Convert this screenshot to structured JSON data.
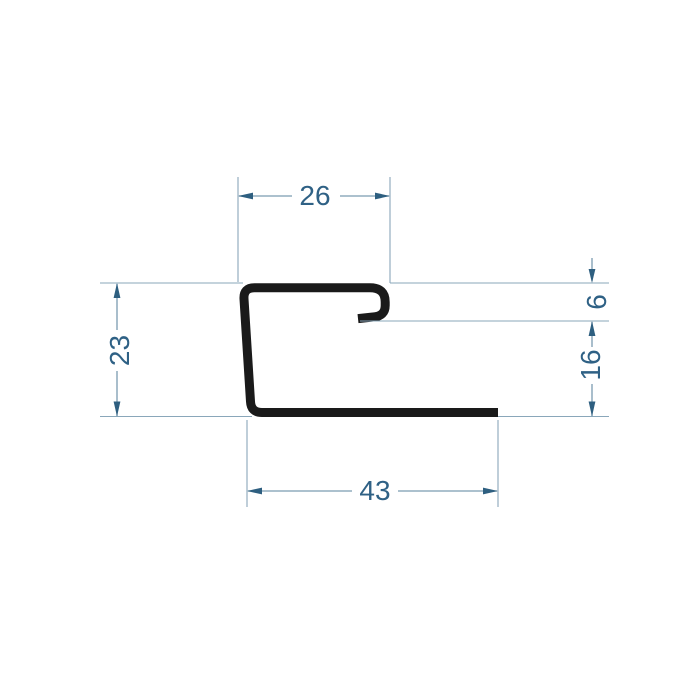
{
  "drawing": {
    "kind": "technical-profile-cross-section",
    "colors": {
      "background": "#ffffff",
      "profile_outline": "#1a1a1a",
      "dimension_lines": "#7b9cb1",
      "dimension_text": "#2f6185",
      "arrowheads": "#2e5f80"
    },
    "dimensions": {
      "top_width": "26",
      "left_height": "23",
      "hook_height": "6",
      "right_lower_height": "16",
      "bottom_width": "43"
    }
  }
}
